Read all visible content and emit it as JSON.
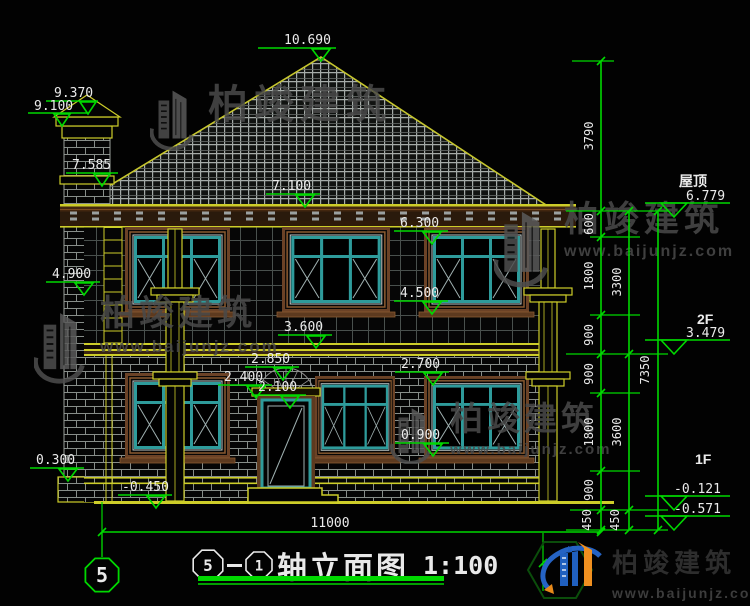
{
  "dims": {
    "peak": "10.690",
    "chimney_top": "9.370",
    "chimney_cap": "9.100",
    "chimney_band": "7.585",
    "eave": "7.100",
    "win2_top": "6.300",
    "capital": "4.900",
    "win2_sill": "4.500",
    "floor2": "3.600",
    "arch_top": "2.850",
    "lintel": "2.400",
    "door_top": "2.100",
    "win1_top": "2.700",
    "win1_sill": "0.900",
    "plinth": "0.300",
    "ground": "-0.450",
    "total_width": "11000"
  },
  "chain": {
    "col_inner": [
      "3790",
      "600",
      "1800",
      "900",
      "900",
      "1800",
      "900",
      "450"
    ],
    "col_mid": [
      "3300",
      "3600",
      "450"
    ],
    "col_outer": [
      "7350"
    ]
  },
  "levels": {
    "roof_label": "屋顶",
    "roof": "6.779",
    "f2_label": "2F",
    "f2": "3.479",
    "f1_label": "1F",
    "f1": "-0.121",
    "ground": "-0.571"
  },
  "title_block": {
    "axis_from": "5",
    "axis_to": "1",
    "name": "轴立面图",
    "scale": "1:100"
  },
  "axis_bubble": {
    "label": "5"
  },
  "watermark": {
    "brand": "柏竣建筑",
    "site": "www.baijunjz.com"
  },
  "logo": {
    "brand": "柏竣建筑",
    "site": "www.baijunjz.com"
  },
  "colors": {
    "dim_green": "#00d800",
    "cad_yellow": "#cdcd29",
    "frame_teal": "#2e9b9b",
    "surround_brown": "#6b4226",
    "text_white": "#ebebeb"
  }
}
